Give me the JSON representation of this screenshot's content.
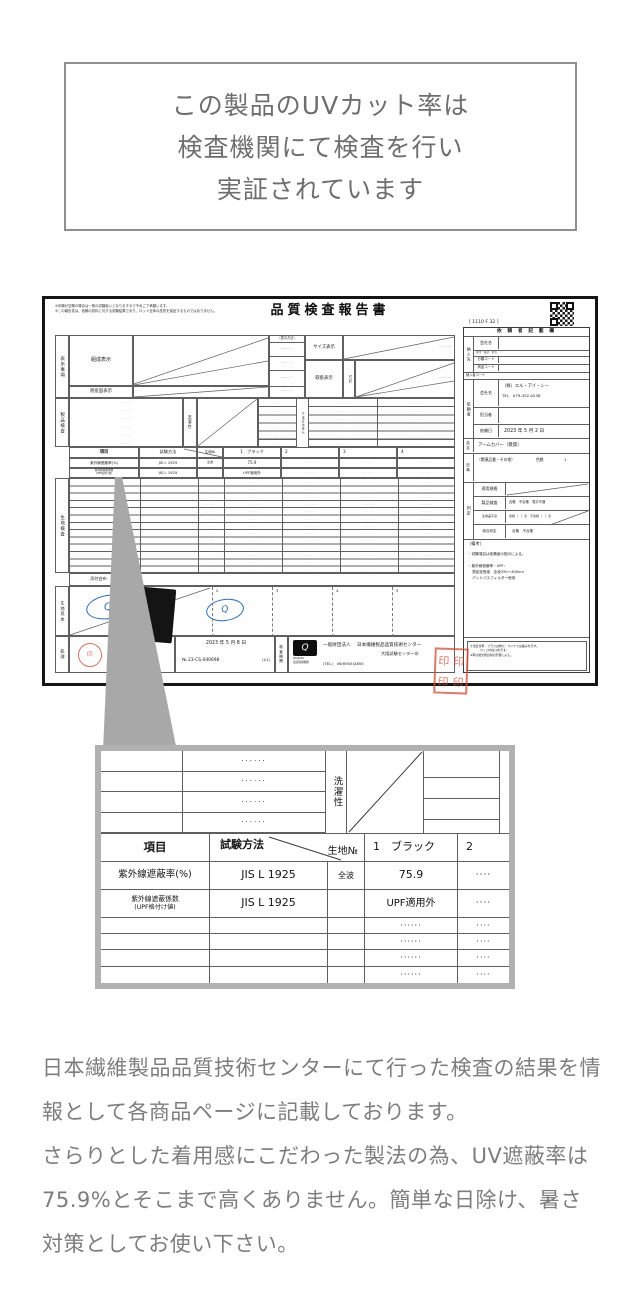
{
  "colors": {
    "form_line": "#5f5f5f",
    "stamp_red": "#c75a49",
    "logo_blue": "#2e6cb0",
    "callout_gray": "#a8a8a8",
    "body_text": "#7d7d7d"
  },
  "claim_box": {
    "line1": "この製品のUVカット率は",
    "line2": "検査機関にて検査を行い",
    "line3": "実証されています"
  },
  "report": {
    "note1": "※印欄が空欄の場合は一般の試験扱いとなりますので予めご了承願います。",
    "note2": "※この報告書は、依頼の試料に対する試験結果であり、ロット全体の品質を保証するものではありません。",
    "title": "品質検査報告書",
    "form_code": "[ 1110 F 32 ]",
    "dots6": "······",
    "dots5": "·····",
    "dots4": "····",
    "display": {
      "section_label": "表示事項",
      "composition": "組成表示",
      "origin": "原産国表示",
      "method": "〔表示方法〕",
      "size": "サイズ表示",
      "care": "取扱表示",
      "fuki": "付記",
      "dim_change": "寸法変化率％",
      "product_test": "製品検査",
      "washing": "洗濯性",
      "fabric_test": "生地検査",
      "attached_cloth": "添付白布",
      "fabric_sample": "生地見本",
      "processing": "処理",
      "inspection_org": "検査機関"
    },
    "table": {
      "h_item": "項目",
      "h_method": "試験方法",
      "h_fabric_no": "生地№",
      "h_col1": "1　ブラック",
      "h_col2": "2",
      "h_col3": "3",
      "h_col4": "4",
      "r1_item": "紫外線遮蔽率(%)",
      "r1_method": "JIS L 1925",
      "r1_band": "全波",
      "r1_value": "75.9",
      "r2_item1": "紫外線遮蔽係数",
      "r2_item2": "(UPF格付け値)",
      "r2_method": "JIS L 1925",
      "r2_value": "UPF適用外"
    },
    "request_panel": {
      "header": "依 頼 者 記 載 欄",
      "supplier_label": "納入先",
      "company_label": "会社名",
      "address_label": "住所・電話・担当",
      "class_code_label": "分類コード",
      "item_code_label": "商品コード",
      "supplier_code_label": "納入者コード",
      "requester_label": "依頼者",
      "requester_company": "（株）エル・アイ・シー",
      "requester_tel": "TEL　079-452-0238",
      "staff_label": "担当者",
      "request_date_label": "依頼日",
      "request_date": "2023 年 5 月 2 日",
      "product_label": "品名",
      "product_name": "アームカバー（雑貨）",
      "article_label": "記事",
      "article_value": "（関連品番・その他）",
      "color_count_label": "色数",
      "color_count": "1",
      "judgement_label": "判定",
      "standard_label": "適用規格",
      "product_test_label": "製品検査",
      "product_test_value": "合格　不合格　表示不適",
      "fabric_defect_label": "生地品不良",
      "fabric_defect_value": "合格（　）点　不合格（　）点",
      "total_label": "総合判定",
      "total_value": "合格　不合格",
      "remarks_title": "（備考）",
      "remarks1": "・試験項目は依頼者の指示による。",
      "remarks2": "・紫外線遮蔽率・UPF：",
      "remarks3": "測定波長域　全波290〜400nm",
      "remarks4": "バンドパスフィルター使用",
      "foot_note1": "寸法変化率：プラスは伸び、マイナスは縮みを示す。",
      "foot_note2": "カッコ内は㎝を示す。",
      "foot_note3": "※率は蛍光増白剤の影響による。"
    },
    "footer": {
      "date": "2023 年 5 月 8 日",
      "report_no": "№ 23-CS-040698",
      "pages": "(1/1)",
      "qtec": "Q",
      "iso1": "ISO9001",
      "iso2": "認証取得機関",
      "org_type": "一般財団法人",
      "org_name": "日本繊維製品品質技術センター",
      "branch": "大阪試験センター㊞",
      "tel": "(TEL)　06(6945)4855",
      "sample_no2": "2",
      "sample_no3": "3",
      "sample_no4": "4",
      "sample_no5": "5",
      "stamp_char": "印"
    }
  },
  "detail_view": {
    "washing": "洗濯性",
    "h_item": "項目",
    "h_method": "試験方法",
    "h_fabric_no": "生地№",
    "h_col1": "1　ブラック",
    "h_col2": "2",
    "r1_item": "紫外線遮蔽率(%)",
    "r1_method": "JIS L 1925",
    "r1_band": "全波",
    "r1_value": "75.9",
    "r2_item1": "紫外線遮蔽係数",
    "r2_item2": "(UPF格付け値)",
    "r2_method": "JIS L 1925",
    "r2_value": "UPF適用外",
    "dots6": "······",
    "dots4": "····"
  },
  "bottom_text": {
    "p1": "日本繊維製品品質技術センターにて行った検査の結果を情報として各商品ページに記載しております。",
    "p2": "さらりとした着用感にこだわった製法の為、UV遮蔽率は75.9%とそこまで高くありません。簡単な日除け、暑さ対策としてお使い下さい。"
  }
}
